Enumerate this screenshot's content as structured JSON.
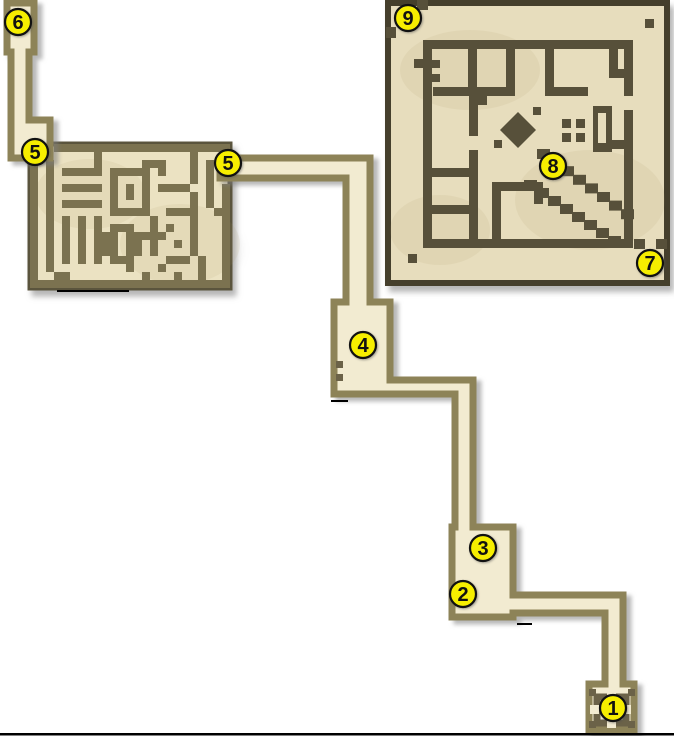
{
  "scene": {
    "width": 674,
    "height": 736,
    "background": "#ffffff",
    "name": "dungeon-walkthrough-map"
  },
  "palette": {
    "corridor_floor": "#f2ebd1",
    "corridor_wall": "#8d8358",
    "corridor_wall_dark": "#6b6248",
    "maze_floor": "#ebe2c2",
    "maze_wall": "#7b7250",
    "maze_edge": "#5a543d",
    "sheet_floor": "#e7ddbd",
    "sheet_wall": "#57503a",
    "sheet_edge": "#453f2c",
    "marker_fill": "#f6ee00",
    "marker_stroke": "#111111",
    "ink": "#111111",
    "artifact": "#000000",
    "texture": "rgba(170,145,95,0.10)"
  },
  "markers": [
    {
      "n": "1",
      "x": 613,
      "y": 708
    },
    {
      "n": "2",
      "x": 463,
      "y": 594
    },
    {
      "n": "3",
      "x": 483,
      "y": 548
    },
    {
      "n": "4",
      "x": 363,
      "y": 345
    },
    {
      "n": "5",
      "x": 35,
      "y": 152
    },
    {
      "n": "5",
      "x": 228,
      "y": 163
    },
    {
      "n": "6",
      "x": 18,
      "y": 22
    },
    {
      "n": "7",
      "x": 650,
      "y": 263
    },
    {
      "n": "8",
      "x": 553,
      "y": 166
    },
    {
      "n": "9",
      "x": 408,
      "y": 18
    }
  ],
  "marker_style": {
    "radius": 13,
    "font_size": 20,
    "stroke_width": 2.2
  },
  "corridors": {
    "stroke_width": 7,
    "west_passage": [
      [
        7,
        3
      ],
      [
        34,
        3
      ],
      [
        34,
        52
      ],
      [
        29,
        52
      ],
      [
        29,
        120
      ],
      [
        50,
        120
      ],
      [
        50,
        158
      ],
      [
        11,
        158
      ],
      [
        11,
        52
      ],
      [
        7,
        52
      ]
    ],
    "main_chain": [
      [
        220,
        158
      ],
      [
        370,
        158
      ],
      [
        370,
        302
      ],
      [
        390,
        302
      ],
      [
        390,
        380
      ],
      [
        473,
        380
      ],
      [
        473,
        527
      ],
      [
        513,
        527
      ],
      [
        513,
        595
      ],
      [
        623,
        595
      ],
      [
        623,
        684
      ],
      [
        634,
        684
      ],
      [
        634,
        730
      ],
      [
        589,
        730
      ],
      [
        589,
        684
      ],
      [
        605,
        684
      ],
      [
        605,
        613
      ],
      [
        513,
        613
      ],
      [
        513,
        617
      ],
      [
        452,
        617
      ],
      [
        452,
        527
      ],
      [
        455,
        527
      ],
      [
        455,
        394
      ],
      [
        390,
        394
      ],
      [
        334,
        394
      ],
      [
        334,
        302
      ],
      [
        346,
        302
      ],
      [
        346,
        178
      ],
      [
        220,
        178
      ]
    ],
    "room4_dots": [
      [
        336,
        361,
        7,
        7
      ],
      [
        336,
        374,
        7,
        7
      ]
    ],
    "room1_glyph": {
      "ring": [
        597,
        697,
        29,
        26
      ],
      "ring_width": 7,
      "gaps": [
        [
          607,
          690,
          9,
          9
        ],
        [
          607,
          719,
          9,
          9
        ],
        [
          590,
          705,
          9,
          9
        ],
        [
          622,
          705,
          9,
          9
        ]
      ],
      "tabs": [
        [
          589,
          689,
          7,
          7
        ],
        [
          628,
          689,
          7,
          7
        ],
        [
          589,
          721,
          7,
          7
        ],
        [
          628,
          721,
          7,
          7
        ]
      ]
    }
  },
  "maze": {
    "x": 30,
    "y": 144,
    "cell": 8,
    "rows": [
      "...######################",
      "........#...........#...#",
      "#.#.....#.....###...#.#..",
      "#.#.#####.#####.#...#.#..",
      "#.#.......#...#.....#.#..",
      "#.#.#####.#.#.#.####..#.#",
      "#.#.......#.#.#.....#.#.#",
      "#.#.#####.#...#.....#.#.#",
      "#.#.......#####..####..##",
      "#.#.#.#.#......#....#...#",
      "#.#.#.#.#.###..#.#..#...#",
      "#.#.#.#.###.#####...#...#",
      "#.#.#.#.###.##.#..#.#...#",
      "#.#.#.#.###.##.#....#...#",
      "#.#.#.#.#.###....###.#..#",
      "#.#.........#...#....#..#",
      "#..##.........#...#..#..#",
      "#########################"
    ]
  },
  "great_hall": {
    "sheet": [
      388,
      3,
      279,
      280
    ],
    "sheet_edge_width": 6,
    "walls": [
      [
        423,
        40,
        210,
        9
      ],
      [
        423,
        40,
        9,
        208
      ],
      [
        423,
        239,
        210,
        9
      ],
      [
        624,
        40,
        9,
        56
      ],
      [
        624,
        110,
        9,
        138
      ],
      [
        468,
        40,
        9,
        48
      ],
      [
        506,
        40,
        9,
        48
      ],
      [
        545,
        40,
        9,
        48
      ],
      [
        433,
        87,
        82,
        9
      ],
      [
        545,
        87,
        43,
        9
      ],
      [
        478,
        96,
        9,
        9
      ],
      [
        609,
        49,
        9,
        21
      ],
      [
        609,
        69,
        16,
        9
      ],
      [
        432,
        60,
        8,
        8
      ],
      [
        432,
        74,
        8,
        8
      ],
      [
        414,
        59,
        10,
        9
      ],
      [
        469,
        96,
        9,
        40
      ],
      [
        469,
        150,
        9,
        89
      ],
      [
        432,
        168,
        37,
        9
      ],
      [
        432,
        205,
        37,
        9
      ],
      [
        492,
        182,
        9,
        57
      ],
      [
        492,
        182,
        51,
        9
      ],
      [
        534,
        182,
        9,
        22
      ],
      [
        610,
        140,
        14,
        9
      ]
    ],
    "stairs": [
      {
        "x": 537,
        "y": 149,
        "dx": 12,
        "dy": 8.6,
        "n": 8,
        "w": 13,
        "h": 10
      },
      {
        "x": 524,
        "y": 180,
        "dx": 12,
        "dy": 8,
        "n": 8,
        "w": 13,
        "h": 10
      }
    ],
    "diamond": [
      [
        518,
        112
      ],
      [
        536,
        130
      ],
      [
        518,
        148
      ],
      [
        500,
        130
      ]
    ],
    "satellites": [
      [
        533,
        107,
        8,
        8
      ],
      [
        494,
        140,
        8,
        8
      ]
    ],
    "dot_grid": [
      [
        562,
        119,
        9,
        9
      ],
      [
        576,
        119,
        9,
        9
      ],
      [
        562,
        133,
        9,
        9
      ],
      [
        576,
        133,
        9,
        9
      ]
    ],
    "slot": {
      "outer": [
        593,
        106,
        19,
        46
      ],
      "inner": [
        598,
        113,
        8,
        30
      ]
    },
    "corner_teeth": [
      [
        417,
        0,
        11,
        10
      ],
      [
        386,
        27,
        10,
        11
      ],
      [
        645,
        19,
        9,
        9
      ],
      [
        408,
        254,
        9,
        9
      ],
      [
        634,
        239,
        11,
        10
      ],
      [
        656,
        239,
        11,
        10
      ],
      [
        645,
        251,
        11,
        10
      ]
    ]
  },
  "artifacts": [
    [
      0,
      733,
      674,
      2.5
    ],
    [
      57,
      290,
      72,
      2
    ],
    [
      331,
      400,
      17,
      2
    ],
    [
      517,
      623,
      15,
      2
    ]
  ]
}
